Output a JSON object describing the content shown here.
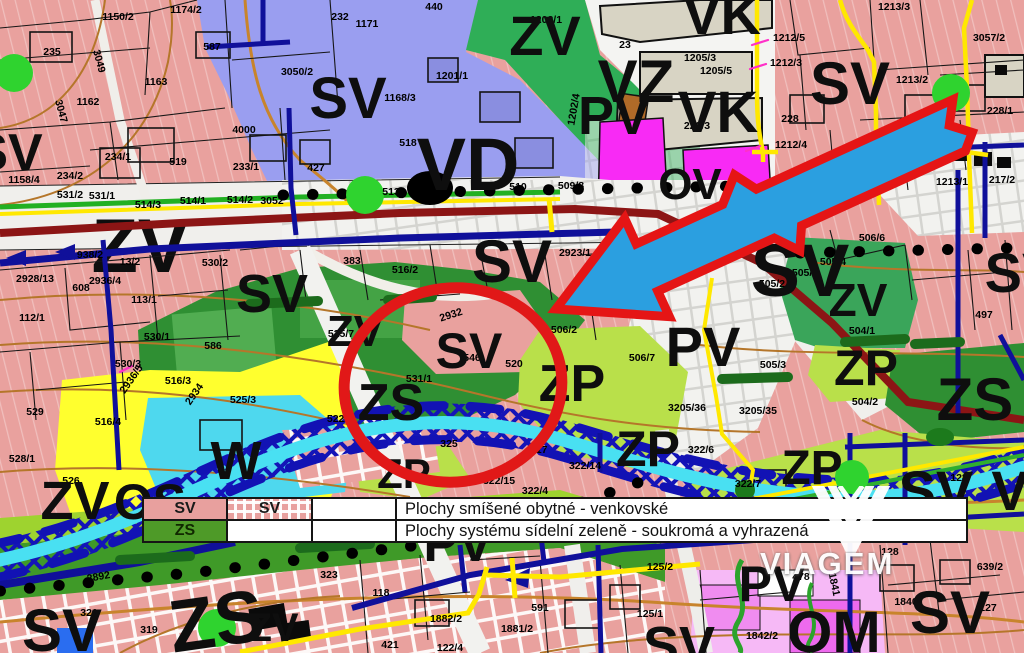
{
  "watermark": {
    "text": "VIAGEM"
  },
  "legend": {
    "rows": [
      {
        "code": "SV",
        "code_hatched": "SV",
        "desc": "Plochy smíšené obytné - venkovské"
      },
      {
        "code": "ZS",
        "code_hatched": "",
        "desc": "Plochy systému sídelní zeleně - soukromá a vyhrazená"
      }
    ]
  },
  "colors": {
    "zone_sv_pink": "#e9a19e",
    "zone_zs_green": "#2f8f33",
    "zone_zv_green": "#2fae57",
    "zone_zp_yellowgreen": "#b9e04a",
    "zone_vd_violet": "#9a9ef0",
    "zone_pv_white": "#f2f2f0",
    "zone_vk_beige": "#d8d4c4",
    "zone_ov_magenta": "#f82af5",
    "zone_om_pink": "#f6b9f6",
    "zone_w_cyan": "#4ed8ee",
    "zone_os_yellow": "#ffff2e",
    "road_major": "#8c1515",
    "utility_navy": "#10109a",
    "boundary_yellow": "#ffe800",
    "contour_brown": "#b5762a",
    "stream_cyan": "#49e0f2",
    "highlight_red": "#e51515",
    "arrow_blue": "#2b9fe0"
  },
  "map": {
    "under_labels": [
      {
        "t": "ZV",
        "x": 140,
        "y": 272,
        "s": 76
      }
    ],
    "zone_labels": [
      {
        "t": "SV",
        "x": 348,
        "y": 118,
        "s": 58
      },
      {
        "t": "SV",
        "x": 8,
        "y": 170,
        "s": 52
      },
      {
        "t": "VD",
        "x": 468,
        "y": 190,
        "s": 74
      },
      {
        "t": "ZV",
        "x": 545,
        "y": 55,
        "s": 56
      },
      {
        "t": "VZ",
        "x": 636,
        "y": 102,
        "s": 60
      },
      {
        "t": "VK",
        "x": 722,
        "y": 34,
        "s": 56
      },
      {
        "t": "VK",
        "x": 718,
        "y": 132,
        "s": 58
      },
      {
        "t": "PV",
        "x": 614,
        "y": 134,
        "s": 54
      },
      {
        "t": "OV",
        "x": 690,
        "y": 199,
        "s": 44
      },
      {
        "t": "SV",
        "x": 850,
        "y": 104,
        "s": 60
      },
      {
        "t": "SV",
        "x": 272,
        "y": 312,
        "s": 54
      },
      {
        "t": "SV",
        "x": 800,
        "y": 296,
        "s": 74
      },
      {
        "t": "SV",
        "x": 512,
        "y": 282,
        "s": 60
      },
      {
        "t": "SV",
        "x": 469,
        "y": 368,
        "s": 50
      },
      {
        "t": "ZS",
        "x": 391,
        "y": 420,
        "s": 52
      },
      {
        "t": "ZV",
        "x": 355,
        "y": 346,
        "s": 44
      },
      {
        "t": "ZV",
        "x": 75,
        "y": 519,
        "s": 54
      },
      {
        "t": "OS",
        "x": 150,
        "y": 519,
        "s": 50
      },
      {
        "t": "W",
        "x": 236,
        "y": 479,
        "s": 54
      },
      {
        "t": "ZS",
        "x": 220,
        "y": 646,
        "s": 74,
        "r": -8
      },
      {
        "t": "ZS",
        "x": 975,
        "y": 420,
        "s": 60
      },
      {
        "t": "SV",
        "x": 62,
        "y": 651,
        "s": 60
      },
      {
        "t": "SV",
        "x": 936,
        "y": 510,
        "s": 56
      },
      {
        "t": "SV",
        "x": 950,
        "y": 633,
        "s": 60
      },
      {
        "t": "OM",
        "x": 834,
        "y": 652,
        "s": 58
      },
      {
        "t": "PV",
        "x": 772,
        "y": 601,
        "s": 50
      },
      {
        "t": "PV",
        "x": 703,
        "y": 366,
        "s": 56
      },
      {
        "t": "ZV",
        "x": 858,
        "y": 316,
        "s": 46
      },
      {
        "t": "ZP",
        "x": 572,
        "y": 401,
        "s": 52
      },
      {
        "t": "ZP",
        "x": 648,
        "y": 466,
        "s": 50
      },
      {
        "t": "ZP",
        "x": 404,
        "y": 488,
        "s": 42
      },
      {
        "t": "ZP",
        "x": 812,
        "y": 484,
        "s": 48
      },
      {
        "t": "ZP",
        "x": 866,
        "y": 385,
        "s": 50
      },
      {
        "t": "SV",
        "x": 679,
        "y": 664,
        "s": 54
      },
      {
        "t": "ZV",
        "x": 273,
        "y": 641,
        "s": 40
      },
      {
        "t": "V",
        "x": 1010,
        "y": 510,
        "s": 56
      },
      {
        "t": "PV",
        "x": 458,
        "y": 561,
        "s": 52
      },
      {
        "t": "SV",
        "x": 1022,
        "y": 292,
        "s": 56
      }
    ],
    "parcel_labels": [
      {
        "t": "1150/2",
        "x": 118,
        "y": 20
      },
      {
        "t": "1174/2",
        "x": 186,
        "y": 13
      },
      {
        "t": "1171",
        "x": 367,
        "y": 27
      },
      {
        "t": "440",
        "x": 434,
        "y": 10
      },
      {
        "t": "232",
        "x": 340,
        "y": 20
      },
      {
        "t": "235",
        "x": 52,
        "y": 55
      },
      {
        "t": "587",
        "x": 212,
        "y": 50
      },
      {
        "t": "1163",
        "x": 156,
        "y": 85
      },
      {
        "t": "1162",
        "x": 88,
        "y": 105
      },
      {
        "t": "3049",
        "x": 96,
        "y": 62,
        "r": 75
      },
      {
        "t": "3047",
        "x": 58,
        "y": 112,
        "r": 75
      },
      {
        "t": "1168/3",
        "x": 400,
        "y": 101
      },
      {
        "t": "519",
        "x": 178,
        "y": 165
      },
      {
        "t": "518",
        "x": 408,
        "y": 146
      },
      {
        "t": "4000",
        "x": 244,
        "y": 133
      },
      {
        "t": "234/1",
        "x": 118,
        "y": 160
      },
      {
        "t": "233/1",
        "x": 246,
        "y": 170
      },
      {
        "t": "427",
        "x": 316,
        "y": 171
      },
      {
        "t": "234/2",
        "x": 70,
        "y": 179
      },
      {
        "t": "1158/4",
        "x": 24,
        "y": 183
      },
      {
        "t": "531/2",
        "x": 70,
        "y": 198
      },
      {
        "t": "531/1",
        "x": 102,
        "y": 199
      },
      {
        "t": "514/3",
        "x": 148,
        "y": 208
      },
      {
        "t": "514/1",
        "x": 193,
        "y": 204
      },
      {
        "t": "514/2",
        "x": 240,
        "y": 203
      },
      {
        "t": "3052",
        "x": 272,
        "y": 204
      },
      {
        "t": "3050/2",
        "x": 297,
        "y": 75
      },
      {
        "t": "513",
        "x": 391,
        "y": 195
      },
      {
        "t": "510",
        "x": 518,
        "y": 190
      },
      {
        "t": "509/8",
        "x": 571,
        "y": 189
      },
      {
        "t": "1201/1",
        "x": 452,
        "y": 79
      },
      {
        "t": "1202/1",
        "x": 546,
        "y": 23
      },
      {
        "t": "1202/4",
        "x": 577,
        "y": 110,
        "r": -80
      },
      {
        "t": "23",
        "x": 625,
        "y": 48
      },
      {
        "t": "1205/3",
        "x": 700,
        "y": 61
      },
      {
        "t": "1205/5",
        "x": 716,
        "y": 74
      },
      {
        "t": "229/3",
        "x": 697,
        "y": 129
      },
      {
        "t": "1213/3",
        "x": 894,
        "y": 10
      },
      {
        "t": "1212/5",
        "x": 789,
        "y": 41
      },
      {
        "t": "1212/3",
        "x": 786,
        "y": 66
      },
      {
        "t": "1213/2",
        "x": 912,
        "y": 83
      },
      {
        "t": "228",
        "x": 790,
        "y": 122
      },
      {
        "t": "1212/4",
        "x": 791,
        "y": 148
      },
      {
        "t": "3057/2",
        "x": 989,
        "y": 41
      },
      {
        "t": "228/1",
        "x": 1000,
        "y": 114
      },
      {
        "t": "1213/1",
        "x": 952,
        "y": 185
      },
      {
        "t": "217/2",
        "x": 1002,
        "y": 183
      },
      {
        "t": "2928/13",
        "x": 35,
        "y": 282
      },
      {
        "t": "608",
        "x": 81,
        "y": 291
      },
      {
        "t": "938/2",
        "x": 90,
        "y": 258
      },
      {
        "t": "2936/4",
        "x": 105,
        "y": 284
      },
      {
        "t": "13/2",
        "x": 130,
        "y": 265
      },
      {
        "t": "530/2",
        "x": 215,
        "y": 266
      },
      {
        "t": "113/1",
        "x": 144,
        "y": 303
      },
      {
        "t": "112/1",
        "x": 32,
        "y": 321
      },
      {
        "t": "530/1",
        "x": 157,
        "y": 340
      },
      {
        "t": "586",
        "x": 213,
        "y": 349
      },
      {
        "t": "530/3",
        "x": 128,
        "y": 367
      },
      {
        "t": "2936/5",
        "x": 134,
        "y": 381,
        "r": -55
      },
      {
        "t": "516/3",
        "x": 178,
        "y": 384
      },
      {
        "t": "2934",
        "x": 197,
        "y": 396,
        "r": -55
      },
      {
        "t": "525/3",
        "x": 243,
        "y": 403
      },
      {
        "t": "529",
        "x": 35,
        "y": 415
      },
      {
        "t": "516/4",
        "x": 108,
        "y": 425
      },
      {
        "t": "522/2",
        "x": 340,
        "y": 422
      },
      {
        "t": "383",
        "x": 352,
        "y": 264
      },
      {
        "t": "516/2",
        "x": 405,
        "y": 273
      },
      {
        "t": "2923/1",
        "x": 575,
        "y": 256
      },
      {
        "t": "2932",
        "x": 452,
        "y": 318,
        "r": -18
      },
      {
        "t": "506/2",
        "x": 564,
        "y": 333
      },
      {
        "t": "520",
        "x": 514,
        "y": 367
      },
      {
        "t": "546",
        "x": 472,
        "y": 361
      },
      {
        "t": "531/1",
        "x": 419,
        "y": 382
      },
      {
        "t": "506/7",
        "x": 642,
        "y": 361
      },
      {
        "t": "497",
        "x": 984,
        "y": 318
      },
      {
        "t": "504/1",
        "x": 862,
        "y": 334
      },
      {
        "t": "505/1",
        "x": 805,
        "y": 276
      },
      {
        "t": "505/2",
        "x": 772,
        "y": 287
      },
      {
        "t": "505/8",
        "x": 785,
        "y": 242
      },
      {
        "t": "506/6",
        "x": 872,
        "y": 241
      },
      {
        "t": "505/3",
        "x": 773,
        "y": 368
      },
      {
        "t": "505/4",
        "x": 833,
        "y": 265
      },
      {
        "t": "504/2",
        "x": 865,
        "y": 405
      },
      {
        "t": "3205/36",
        "x": 687,
        "y": 411
      },
      {
        "t": "3205/35",
        "x": 758,
        "y": 414
      },
      {
        "t": "322/6",
        "x": 701,
        "y": 453
      },
      {
        "t": "322/14",
        "x": 585,
        "y": 469
      },
      {
        "t": "117",
        "x": 539,
        "y": 453
      },
      {
        "t": "325",
        "x": 449,
        "y": 447
      },
      {
        "t": "322/5",
        "x": 451,
        "y": 486
      },
      {
        "t": "322/15",
        "x": 499,
        "y": 484
      },
      {
        "t": "322/4",
        "x": 535,
        "y": 494
      },
      {
        "t": "525/7",
        "x": 341,
        "y": 337
      },
      {
        "t": "118",
        "x": 381,
        "y": 596
      },
      {
        "t": "1882/2",
        "x": 446,
        "y": 622
      },
      {
        "t": "1881/2",
        "x": 517,
        "y": 632
      },
      {
        "t": "421",
        "x": 390,
        "y": 648
      },
      {
        "t": "122/4",
        "x": 450,
        "y": 651
      },
      {
        "t": "591",
        "x": 540,
        "y": 611
      },
      {
        "t": "125/2",
        "x": 660,
        "y": 570
      },
      {
        "t": "125/1",
        "x": 650,
        "y": 617
      },
      {
        "t": "478",
        "x": 801,
        "y": 580
      },
      {
        "t": "1841",
        "x": 831,
        "y": 585,
        "r": 78
      },
      {
        "t": "1840",
        "x": 906,
        "y": 605
      },
      {
        "t": "1842/2",
        "x": 762,
        "y": 639
      },
      {
        "t": "128",
        "x": 959,
        "y": 481
      },
      {
        "t": "128",
        "x": 890,
        "y": 555
      },
      {
        "t": "639/2",
        "x": 990,
        "y": 570
      },
      {
        "t": "127",
        "x": 988,
        "y": 611
      },
      {
        "t": "322/7",
        "x": 748,
        "y": 487
      },
      {
        "t": "323",
        "x": 329,
        "y": 578
      },
      {
        "t": "321",
        "x": 89,
        "y": 616
      },
      {
        "t": "319",
        "x": 149,
        "y": 633
      },
      {
        "t": "2892",
        "x": 99,
        "y": 580,
        "r": -10
      },
      {
        "t": "528/1",
        "x": 22,
        "y": 462
      },
      {
        "t": "526",
        "x": 71,
        "y": 484
      }
    ]
  }
}
